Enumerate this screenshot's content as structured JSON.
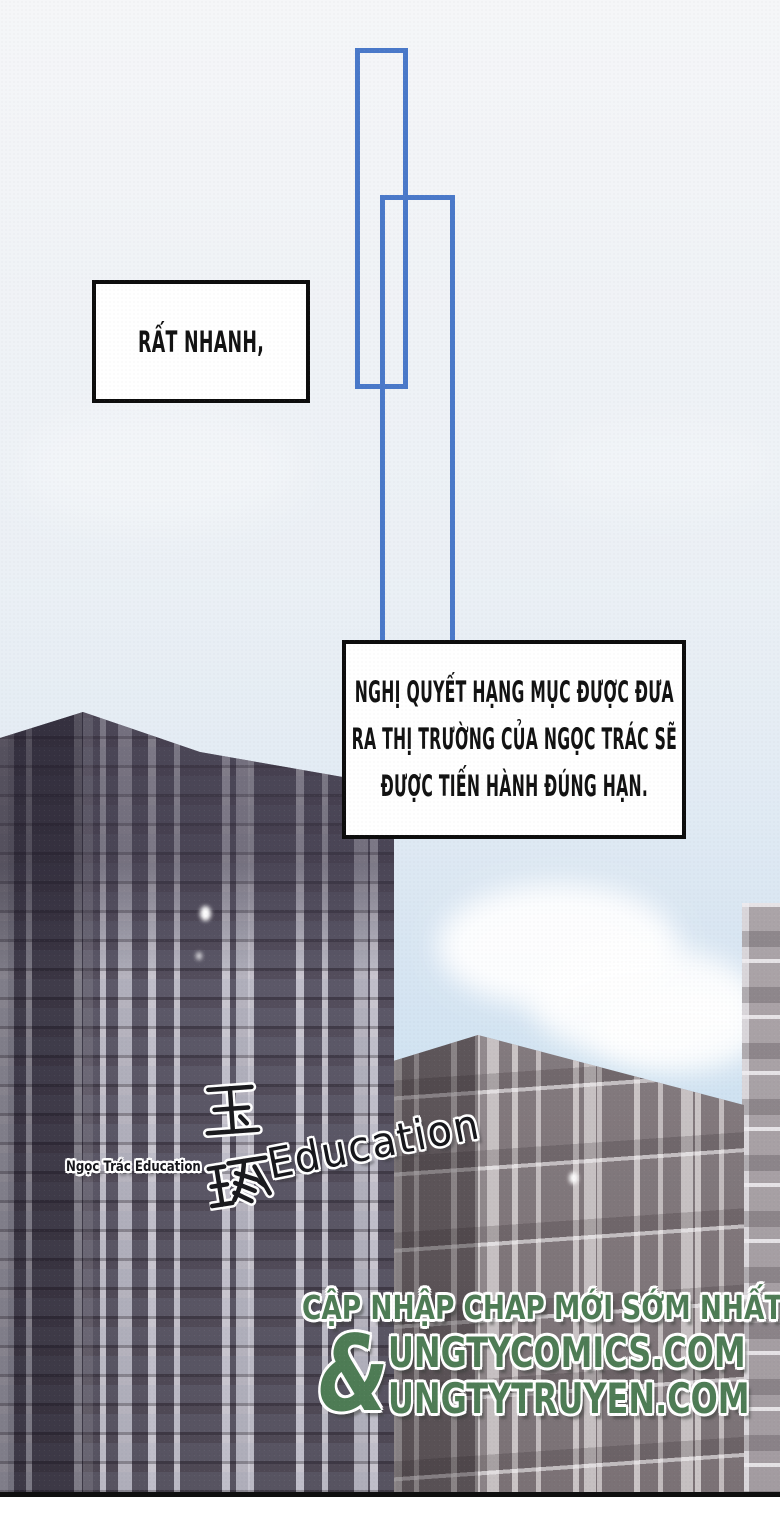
{
  "panel": {
    "speech1": {
      "text": "RẤT NHANH,"
    },
    "speech2": {
      "line1": "NGHỊ QUYẾT HẠNG MỤC ĐƯỢC ĐƯA",
      "line2": "RA THỊ TRƯỜNG CỦA NGỌC TRÁC SẼ",
      "line3": "ĐƯỢC TIẾN HÀNH ĐÚNG HẠN."
    },
    "building_sign": {
      "small_label": "Ngọc Trác Education",
      "hanzi_top": "玉",
      "hanzi_bottom": "琢",
      "english": "Education"
    },
    "watermark": {
      "line1": "CẬP NHẬP CHAP MỚI SỚM NHẤT TẠI",
      "ampersand": "&",
      "url1": "UNGTYCOMICS.COM",
      "url2": "UNGTYTRUYEN.COM"
    }
  },
  "colors": {
    "panel-blue": "#4a79c9",
    "watermark-green": "#4e7c55",
    "sky-top": "#f5f6f8",
    "sky-blue": "#cfe2f1",
    "building-dark": "#565060",
    "building-mid": "#837a7e",
    "building-light": "#aba4a8"
  }
}
